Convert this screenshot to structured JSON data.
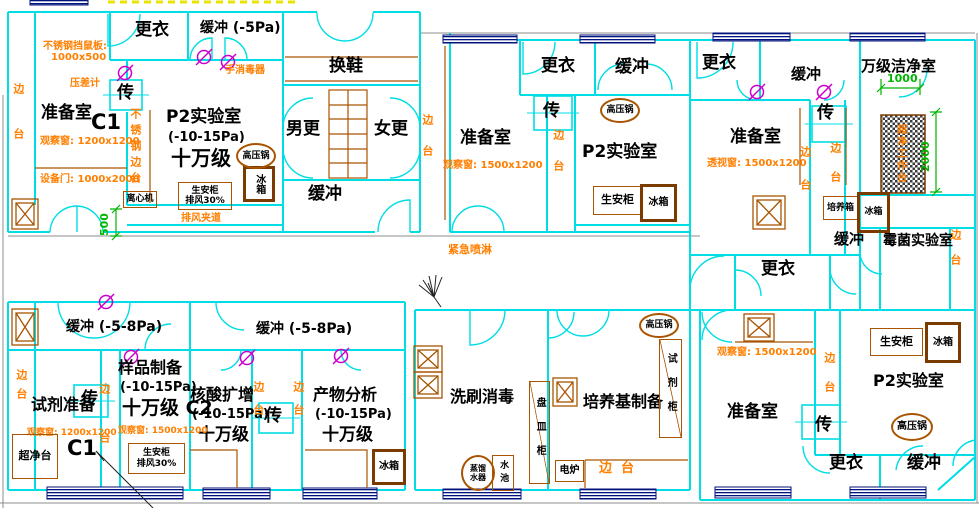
{
  "drawing": {
    "colors": {
      "wall": "#00dde4",
      "annotation": "#ff7f00",
      "room_label": "#000000",
      "dimension": "#00b400",
      "window": "#00127e",
      "furniture": "#a85400",
      "door_symbol": "#cc00cc",
      "highlight_dash": "#e8e400"
    },
    "labels": [
      {
        "n": "room-label-genyi-a",
        "t": "更衣",
        "x": 135,
        "y": 21,
        "fs": 17,
        "c": "k"
      },
      {
        "n": "room-label-huanchong-a",
        "t": "缓冲 (-5Pa)",
        "x": 200,
        "y": 21,
        "fs": 14,
        "c": "k"
      },
      {
        "n": "room-label-zhunbeishi-a",
        "t": "准备室",
        "x": 41,
        "y": 104,
        "fs": 17,
        "c": "k"
      },
      {
        "n": "room-code-c1-a",
        "t": "C1",
        "x": 91,
        "y": 111,
        "fs": 21,
        "c": "k"
      },
      {
        "n": "room-label-p2lab-a",
        "t": "P2实验室",
        "x": 166,
        "y": 108,
        "fs": 17,
        "c": "k"
      },
      {
        "n": "pressure-p2lab-a",
        "t": "(-10-15Pa)",
        "x": 168,
        "y": 131,
        "fs": 13,
        "c": "k"
      },
      {
        "n": "class-p2lab-a",
        "t": "十万级",
        "x": 171,
        "y": 148,
        "fs": 20,
        "c": "k"
      },
      {
        "n": "pass-box-char-a",
        "t": "传",
        "x": 117,
        "y": 84,
        "fs": 17,
        "c": "k"
      },
      {
        "n": "room-label-huanxie",
        "t": "换鞋",
        "x": 329,
        "y": 57,
        "fs": 17,
        "c": "k"
      },
      {
        "n": "room-label-nangeng",
        "t": "男更",
        "x": 286,
        "y": 120,
        "fs": 17,
        "c": "k"
      },
      {
        "n": "room-label-nvgeng",
        "t": "女更",
        "x": 374,
        "y": 120,
        "fs": 17,
        "c": "k"
      },
      {
        "n": "room-label-huanchong-b",
        "t": "缓冲",
        "x": 308,
        "y": 185,
        "fs": 17,
        "c": "k"
      },
      {
        "n": "room-label-genyi-c",
        "t": "更衣",
        "x": 541,
        "y": 57,
        "fs": 17,
        "c": "k"
      },
      {
        "n": "room-label-huanchong-c",
        "t": "缓冲",
        "x": 615,
        "y": 58,
        "fs": 17,
        "c": "k"
      },
      {
        "n": "pass-box-char-c",
        "t": "传",
        "x": 543,
        "y": 102,
        "fs": 17,
        "c": "k"
      },
      {
        "n": "room-label-zhunbeishi-c",
        "t": "准备室",
        "x": 460,
        "y": 129,
        "fs": 17,
        "c": "k"
      },
      {
        "n": "room-label-p2lab-c",
        "t": "P2实验室",
        "x": 582,
        "y": 143,
        "fs": 17,
        "c": "k"
      },
      {
        "n": "room-label-genyi-d",
        "t": "更衣",
        "x": 702,
        "y": 54,
        "fs": 17,
        "c": "k"
      },
      {
        "n": "room-label-huanchong-d",
        "t": "缓冲",
        "x": 791,
        "y": 66,
        "fs": 15,
        "c": "k"
      },
      {
        "n": "room-label-zhunbeishi-d",
        "t": "准备室",
        "x": 730,
        "y": 128,
        "fs": 17,
        "c": "k"
      },
      {
        "n": "pass-box-char-d",
        "t": "传",
        "x": 817,
        "y": 104,
        "fs": 17,
        "c": "k"
      },
      {
        "n": "room-label-wanji-clean",
        "t": "万级洁净室",
        "x": 861,
        "y": 58,
        "fs": 15,
        "c": "k"
      },
      {
        "n": "room-label-huanchong-e",
        "t": "缓冲",
        "x": 834,
        "y": 231,
        "fs": 15,
        "c": "k"
      },
      {
        "n": "room-label-meijun-lab",
        "t": "霉菌实验室",
        "x": 883,
        "y": 234,
        "fs": 14,
        "c": "k"
      },
      {
        "n": "room-label-genyi-mid",
        "t": "更衣",
        "x": 761,
        "y": 260,
        "fs": 17,
        "c": "k"
      },
      {
        "n": "room-label-huanchong-f1",
        "t": "缓冲 (-5-8Pa)",
        "x": 66,
        "y": 320,
        "fs": 14,
        "c": "k"
      },
      {
        "n": "room-label-huanchong-f2",
        "t": "缓冲 (-5-8Pa)",
        "x": 256,
        "y": 322,
        "fs": 14,
        "c": "k"
      },
      {
        "n": "room-label-shiji-zhunbei",
        "t": "试剂准备",
        "x": 31,
        "y": 396,
        "fs": 16,
        "c": "k"
      },
      {
        "n": "room-code-c1-f",
        "t": "C1",
        "x": 67,
        "y": 437,
        "fs": 21,
        "c": "k"
      },
      {
        "n": "pass-box-char-f1",
        "t": "传",
        "x": 81,
        "y": 390,
        "fs": 17,
        "c": "k"
      },
      {
        "n": "room-label-yangpin",
        "t": "样品制备",
        "x": 118,
        "y": 359,
        "fs": 16,
        "c": "k"
      },
      {
        "n": "pressure-yangpin",
        "t": "(-10-15Pa)",
        "x": 120,
        "y": 381,
        "fs": 13,
        "c": "k"
      },
      {
        "n": "class-yangpin",
        "t": "十万级 C2",
        "x": 122,
        "y": 398,
        "fs": 19,
        "c": "k"
      },
      {
        "n": "room-label-hesuan",
        "t": "核酸扩增",
        "x": 190,
        "y": 386,
        "fs": 16,
        "c": "k"
      },
      {
        "n": "pressure-hesuan",
        "t": "(-10-15Pa)",
        "x": 192,
        "y": 408,
        "fs": 13,
        "c": "k"
      },
      {
        "n": "class-hesuan",
        "t": "十万级",
        "x": 198,
        "y": 426,
        "fs": 17,
        "c": "k"
      },
      {
        "n": "pass-box-char-f2",
        "t": "传",
        "x": 265,
        "y": 407,
        "fs": 17,
        "c": "k"
      },
      {
        "n": "room-label-chanwu",
        "t": "产物分析",
        "x": 313,
        "y": 386,
        "fs": 16,
        "c": "k"
      },
      {
        "n": "pressure-chanwu",
        "t": "(-10-15Pa)",
        "x": 315,
        "y": 408,
        "fs": 13,
        "c": "k"
      },
      {
        "n": "class-chanwu",
        "t": "十万级",
        "x": 322,
        "y": 426,
        "fs": 17,
        "c": "k"
      },
      {
        "n": "room-label-xishua",
        "t": "洗刷消毒",
        "x": 450,
        "y": 388,
        "fs": 16,
        "c": "k"
      },
      {
        "n": "room-label-peiyangji",
        "t": "培养基制备",
        "x": 583,
        "y": 393,
        "fs": 16,
        "c": "k"
      },
      {
        "n": "room-label-zhunbeishi-h",
        "t": "准备室",
        "x": 727,
        "y": 403,
        "fs": 17,
        "c": "k"
      },
      {
        "n": "room-label-p2lab-h",
        "t": "P2实验室",
        "x": 873,
        "y": 372,
        "fs": 16,
        "c": "k"
      },
      {
        "n": "pass-box-char-h",
        "t": "传",
        "x": 815,
        "y": 416,
        "fs": 17,
        "c": "k"
      },
      {
        "n": "room-label-genyi-h",
        "t": "更衣",
        "x": 829,
        "y": 454,
        "fs": 17,
        "c": "k"
      },
      {
        "n": "room-label-huanchong-h",
        "t": "缓冲",
        "x": 907,
        "y": 454,
        "fs": 17,
        "c": "k"
      },
      {
        "n": "note-rodent-board",
        "t": "不锈钢挡鼠板:",
        "x": 43,
        "y": 42,
        "fs": 10,
        "c": "o"
      },
      {
        "n": "note-rodent-board-size",
        "t": "1000x500",
        "x": 51,
        "y": 53,
        "fs": 10,
        "c": "o"
      },
      {
        "n": "note-pressure-gauge",
        "t": "压差计",
        "x": 70,
        "y": 79,
        "fs": 10,
        "c": "o"
      },
      {
        "n": "note-hand-sanitizer",
        "t": "手消毒器",
        "x": 225,
        "y": 66,
        "fs": 10,
        "c": "o"
      },
      {
        "n": "note-obs-window-a",
        "t": "观察窗: 1200x1200",
        "x": 40,
        "y": 137,
        "fs": 10,
        "c": "o"
      },
      {
        "n": "note-equip-door-a",
        "t": "设备门: 1000x2000",
        "x": 40,
        "y": 175,
        "fs": 10,
        "c": "o"
      },
      {
        "n": "note-exhaust-passage",
        "t": "排风夹道",
        "x": 181,
        "y": 214,
        "fs": 10,
        "c": "o"
      },
      {
        "n": "note-emergency-shower",
        "t": "紧急喷淋",
        "x": 448,
        "y": 244,
        "fs": 11,
        "c": "o"
      },
      {
        "n": "note-obs-window-c",
        "t": "观察窗: 1500x1200",
        "x": 443,
        "y": 161,
        "fs": 10,
        "c": "o"
      },
      {
        "n": "note-view-window-d",
        "t": "透视窗: 1500x1200",
        "x": 707,
        "y": 159,
        "fs": 10,
        "c": "o"
      },
      {
        "n": "note-obs-window-f1",
        "t": "观察窗: 1200x1200",
        "x": 27,
        "y": 429,
        "fs": 9,
        "c": "o"
      },
      {
        "n": "note-obs-window-f2",
        "t": "观察窗: 1500x1200",
        "x": 118,
        "y": 427,
        "fs": 9,
        "c": "o"
      },
      {
        "n": "note-obs-window-h",
        "t": "观察窗: 1500x1200",
        "x": 717,
        "y": 348,
        "fs": 10,
        "c": "o"
      },
      {
        "n": "note-bench-g",
        "t": "边  台",
        "x": 599,
        "y": 462,
        "fs": 13,
        "c": "o"
      },
      {
        "n": "note-bench-a-left",
        "t": "边台",
        "x": 12,
        "y": 83,
        "fs": 11,
        "c": "o",
        "v": 1,
        "ls": 34
      },
      {
        "n": "note-bench-corridor-bc",
        "t": "边台",
        "x": 421,
        "y": 114,
        "fs": 11,
        "c": "o",
        "v": 1,
        "ls": 20
      },
      {
        "n": "note-bench-c",
        "t": "边台",
        "x": 552,
        "y": 129,
        "fs": 11,
        "c": "o",
        "v": 1,
        "ls": 20
      },
      {
        "n": "note-bench-d1",
        "t": "边台",
        "x": 799,
        "y": 146,
        "fs": 11,
        "c": "o",
        "v": 1,
        "ls": 22
      },
      {
        "n": "note-bench-d2",
        "t": "边台",
        "x": 829,
        "y": 142,
        "fs": 11,
        "c": "o",
        "v": 1,
        "ls": 18
      },
      {
        "n": "note-bench-e",
        "t": "边台",
        "x": 949,
        "y": 229,
        "fs": 11,
        "c": "o",
        "v": 1,
        "ls": 14
      },
      {
        "n": "note-bench-f-left",
        "t": "边台",
        "x": 15,
        "y": 369,
        "fs": 11,
        "c": "o",
        "v": 1,
        "ls": 8
      },
      {
        "n": "note-bench-f-strip1",
        "t": "边台",
        "x": 98,
        "y": 383,
        "fs": 11,
        "c": "o",
        "v": 1,
        "ls": 38
      },
      {
        "n": "note-bench-f-strip2",
        "t": "边台",
        "x": 252,
        "y": 381,
        "fs": 11,
        "c": "o",
        "v": 1,
        "ls": 12
      },
      {
        "n": "note-bench-f-strip3",
        "t": "边台",
        "x": 292,
        "y": 381,
        "fs": 11,
        "c": "o",
        "v": 1,
        "ls": 12
      },
      {
        "n": "note-bench-h-strip",
        "t": "边台",
        "x": 823,
        "y": 352,
        "fs": 11,
        "c": "o",
        "v": 1,
        "ls": 18
      },
      {
        "n": "note-ss-bench-a",
        "t": "不锈钢边台",
        "x": 129,
        "y": 108,
        "fs": 11,
        "c": "o",
        "v": 1,
        "ls": 5
      },
      {
        "n": "note-clean-workbench",
        "t": "超净工作台",
        "x": 894,
        "y": 124,
        "fs": 10,
        "c": "o",
        "v": 1,
        "ls": 2
      },
      {
        "n": "dim-500",
        "t": "500",
        "x": 99,
        "y": 236,
        "fs": 11,
        "c": "g",
        "rot": -90
      },
      {
        "n": "dim-1000",
        "t": "1000",
        "x": 887,
        "y": 73,
        "fs": 11,
        "c": "g"
      },
      {
        "n": "dim-2000",
        "t": "2000",
        "x": 920,
        "y": 172,
        "fs": 11,
        "c": "g",
        "rot": -90
      }
    ],
    "boxes": [
      {
        "n": "biosafety-cabinet-a",
        "text": "生安柜\n排风30%",
        "x": 178,
        "y": 182,
        "w": 52,
        "h": 26,
        "sh": "rect",
        "fs": 9
      },
      {
        "n": "fridge-a",
        "text": "冰箱",
        "x": 243,
        "y": 166,
        "w": 26,
        "h": 30,
        "sh": "thick",
        "fs": 10,
        "v": 1
      },
      {
        "n": "centrifuge-a",
        "text": "离心机",
        "x": 123,
        "y": 191,
        "w": 32,
        "h": 15,
        "sh": "rect",
        "fs": 9
      },
      {
        "n": "biosafety-cabinet-c",
        "text": "生安柜",
        "x": 593,
        "y": 186,
        "w": 47,
        "h": 27,
        "sh": "rect",
        "fs": 11
      },
      {
        "n": "fridge-c",
        "text": "冰箱",
        "x": 640,
        "y": 184,
        "w": 31,
        "h": 32,
        "sh": "thick",
        "fs": 10
      },
      {
        "n": "incubator-e",
        "text": "培养箱",
        "x": 823,
        "y": 196,
        "w": 33,
        "h": 22,
        "sh": "rect",
        "fs": 9
      },
      {
        "n": "fridge-e",
        "text": "冰箱",
        "x": 857,
        "y": 192,
        "w": 27,
        "h": 35,
        "sh": "thick",
        "fs": 9
      },
      {
        "n": "biosafety-cabinet-f",
        "text": "生安柜\n排风30%",
        "x": 128,
        "y": 443,
        "w": 55,
        "h": 29,
        "sh": "rect",
        "fs": 9
      },
      {
        "n": "clean-bench-f",
        "text": "超净台",
        "x": 12,
        "y": 434,
        "w": 44,
        "h": 43,
        "sh": "rect",
        "fs": 11
      },
      {
        "n": "fridge-f",
        "text": "冰箱",
        "x": 372,
        "y": 449,
        "w": 28,
        "h": 30,
        "sh": "thick",
        "fs": 10
      },
      {
        "n": "dish-cabinet-g",
        "text": "盘皿柜",
        "x": 529,
        "y": 381,
        "w": 19,
        "h": 101,
        "sh": "cab",
        "fs": 10,
        "v": 1,
        "ls": 14
      },
      {
        "n": "reagent-cabinet-g",
        "text": "试剂柜",
        "x": 659,
        "y": 339,
        "w": 21,
        "h": 97,
        "sh": "cab",
        "fs": 10,
        "v": 1,
        "ls": 14
      },
      {
        "n": "electric-stove-g",
        "text": "电炉",
        "x": 555,
        "y": 460,
        "w": 27,
        "h": 20,
        "sh": "rect",
        "fs": 10
      },
      {
        "n": "biosafety-cabinet-h",
        "text": "生安柜",
        "x": 870,
        "y": 328,
        "w": 51,
        "h": 26,
        "sh": "rect",
        "fs": 11
      },
      {
        "n": "fridge-h",
        "text": "冰箱",
        "x": 925,
        "y": 322,
        "w": 30,
        "h": 35,
        "sh": "thick",
        "fs": 10
      },
      {
        "n": "water-distiller-g",
        "text": "蒸馏\n水器",
        "x": 461,
        "y": 455,
        "w": 30,
        "h": 32,
        "sh": "circle",
        "fs": 8
      },
      {
        "n": "sink-label-g",
        "text": "水池",
        "x": 492,
        "y": 455,
        "w": 20,
        "h": 34,
        "sh": "rect",
        "fs": 9,
        "v": 1,
        "ls": 4
      },
      {
        "n": "autoclave-a",
        "text": "高压锅",
        "x": 236,
        "y": 143,
        "w": 36,
        "h": 22,
        "sh": "circle",
        "fs": 9
      },
      {
        "n": "autoclave-c",
        "text": "高压锅",
        "x": 600,
        "y": 98,
        "w": 36,
        "h": 21,
        "sh": "circle",
        "fs": 9
      },
      {
        "n": "autoclave-g",
        "text": "高压锅",
        "x": 639,
        "y": 313,
        "w": 36,
        "h": 21,
        "sh": "circle",
        "fs": 9
      },
      {
        "n": "autoclave-h",
        "text": "高压锅",
        "x": 891,
        "y": 413,
        "w": 38,
        "h": 24,
        "sh": "circle",
        "fs": 10
      }
    ]
  }
}
